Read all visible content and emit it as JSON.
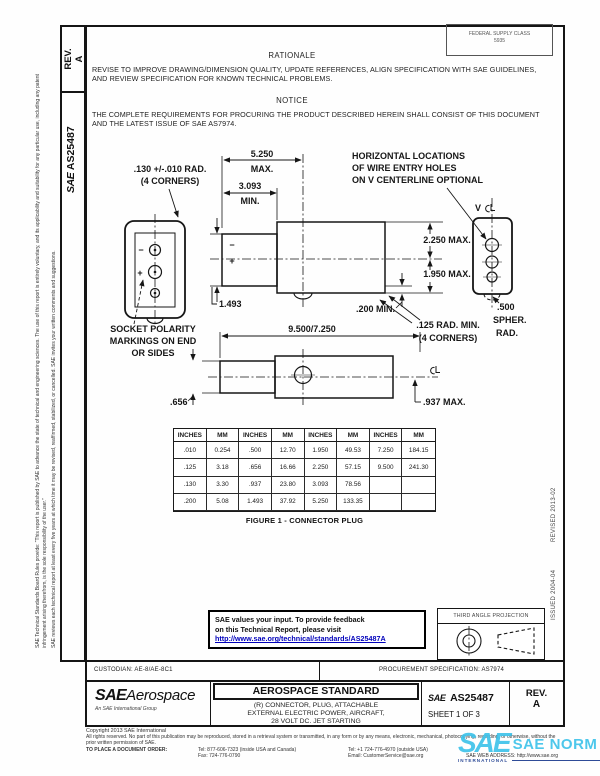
{
  "colors": {
    "link": "#0000bb",
    "watermark_cyan": "#3ec3ea",
    "watermark_navy": "#1d3c8f",
    "ink": "#111111"
  },
  "sidebar": {
    "rev_label": "REV.",
    "rev_value": "A",
    "sae": "SAE",
    "doc_number": "AS25487",
    "disclaimer_1": "SAE Technical Standards Board Rules provide: “This report is published by SAE to advance the state of technical and engineering sciences. The use of this report is entirely voluntary, and its applicability and suitability for any particular use, including any patent infringement arising therefrom, is the sole responsibility of the user.”",
    "disclaimer_2": "SAE reviews each technical report at least every five years at which time it may be revised, reaffirmed, stabilized, or cancelled. SAE invites your written comments and suggestions.",
    "issued": "ISSUED 2004-04",
    "revised": "REVISED 2013-02"
  },
  "header": {
    "fsc_line1": "FEDERAL SUPPLY CLASS",
    "fsc_line2": "5935",
    "rationale_heading": "RATIONALE",
    "rationale_body": "REVISE TO IMPROVE DRAWING/DIMENSION QUALITY, UPDATE REFERENCES, ALIGN SPECIFICATION WITH SAE GUIDELINES, AND REVIEW SPECIFICATION FOR KNOWN TECHNICAL PROBLEMS.",
    "notice_heading": "NOTICE",
    "notice_body": "THE COMPLETE REQUIREMENTS FOR PROCURING THE PRODUCT DESCRIBED HEREIN SHALL CONSIST OF THIS DOCUMENT AND THE LATEST ISSUE OF SAE AS7974."
  },
  "drawing": {
    "rad130_1": ".130 +/-.010 RAD.",
    "rad130_2": "(4 CORNERS)",
    "socket_1": "SOCKET POLARITY",
    "socket_2": "MARKINGS ON END",
    "socket_3": "OR SIDES",
    "d5250": "5.250",
    "d5250_sub": "MAX.",
    "d3093": "3.093",
    "d3093_sub": "MIN.",
    "d1493": "1.493",
    "horiz_1": "HORIZONTAL LOCATIONS",
    "horiz_2": "OF WIRE ENTRY HOLES",
    "horiz_3": "ON V CENTERLINE OPTIONAL",
    "v_label": "V",
    "d2250": "2.250 MAX.",
    "d1950": "1.950 MAX.",
    "d200": ".200 MIN.",
    "rad125_1": ".125 RAD. MIN.",
    "rad125_2": "(4 CORNERS)",
    "spher_1": ".500",
    "spher_2": "SPHER.",
    "spher_3": "RAD.",
    "d9500": "9.500/7.250",
    "d656": ".656",
    "d937": ".937 MAX.",
    "plus": "+",
    "minus": "−"
  },
  "table": {
    "headers": [
      "INCHES",
      "MM",
      "INCHES",
      "MM",
      "INCHES",
      "MM",
      "INCHES",
      "MM"
    ],
    "rows": [
      [
        ".010",
        "0.254",
        ".500",
        "12.70",
        "1.950",
        "49.53",
        "7.250",
        "184.15"
      ],
      [
        ".125",
        "3.18",
        ".656",
        "16.66",
        "2.250",
        "57.15",
        "9.500",
        "241.30"
      ],
      [
        ".130",
        "3.30",
        ".937",
        "23.80",
        "3.093",
        "78.56",
        "",
        ""
      ],
      [
        ".200",
        "5.08",
        "1.493",
        "37.92",
        "5.250",
        "133.35",
        "",
        ""
      ]
    ]
  },
  "figure_caption": "FIGURE 1 - CONNECTOR PLUG",
  "feedback": {
    "line1": "SAE values your input. To provide feedback",
    "line2": "on this Technical Report, please visit",
    "url": "http://www.sae.org/technical/standards/AS25487A"
  },
  "projection": {
    "label": "THIRD ANGLE PROJECTION"
  },
  "footer": {
    "custodian": "CUSTODIAN: AE-8/AE-8C1",
    "procurement": "PROCUREMENT SPECIFICATION: AS7974",
    "logo_sae": "SAE",
    "logo_aerospace": "Aerospace",
    "logo_tagline": "An SAE International Group",
    "doc_type": "AEROSPACE STANDARD",
    "title_1": "(R) CONNECTOR, PLUG, ATTACHABLE",
    "title_2": "EXTERNAL ELECTRIC POWER, AIRCRAFT,",
    "title_3": "28 VOLT DC. JET STARTING",
    "id_sae": "SAE",
    "id_number": "AS25487",
    "sheet": "SHEET 1 OF 3",
    "rev_label": "REV.",
    "rev_value": "A"
  },
  "copyright": {
    "line1": "Copyright 2013 SAE International",
    "rights": "All rights reserved. No part of this publication may be reproduced, stored in a retrieval system or transmitted, in any form or by any means, electronic, mechanical, photocopying, recording, or otherwise, without the prior written permission of SAE.",
    "order_label": "TO PLACE A DOCUMENT ORDER:",
    "tel_inside": "Tel: 877-606-7323 (inside USA and Canada)",
    "fax": "Fax: 724-776-0790",
    "tel_outside": "Tel: +1 724-776-4970 (outside USA)",
    "email": "Email: CustomerService@sae.org",
    "web": "SAE WEB ADDRESS: http://www.sae.org"
  },
  "watermark": {
    "sae": "SAE",
    "norm": "SAE NORM",
    "sub": "INTERNATIONAL"
  }
}
